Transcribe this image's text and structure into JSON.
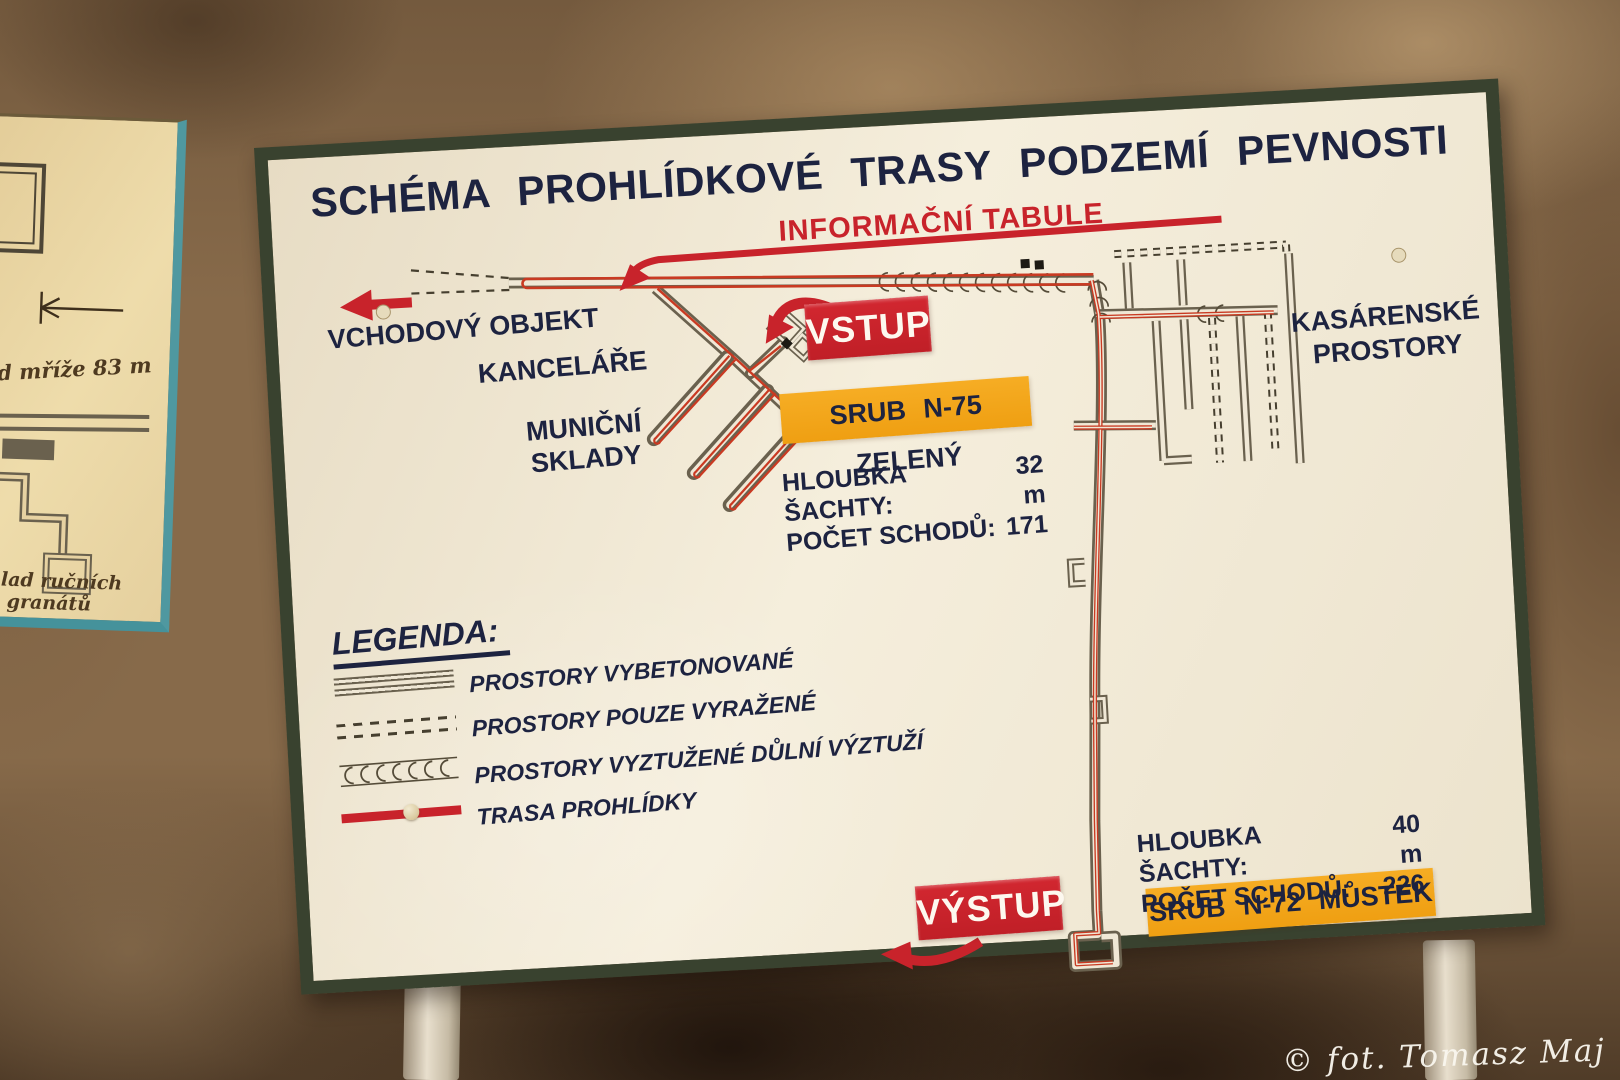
{
  "watermark": "© fot. Tomasz Maj",
  "main_sign": {
    "title": "SCHÉMA PROHLÍDKOVÉ TRASY PODZEMÍ PEVNOSTI",
    "info_board": "INFORMAČNÍ TABULE",
    "entrance_object": "VCHODOVÝ OBJEKT",
    "offices": "KANCELÁŘE",
    "ammo_depot_line1": "MUNIČNÍ",
    "ammo_depot_line2": "SKLADY",
    "barracks_line1": "KASÁRENSKÉ",
    "barracks_line2": "PROSTORY",
    "entry_badge": "VSTUP",
    "exit_badge": "VÝSTUP",
    "bunker_n75_badge": "SRUB N-75 ZELENÝ",
    "bunker_n72_badge": "SRUB N-72 MŮSTEK",
    "shaft_n75": {
      "depth_label": "HLOUBKA ŠACHTY:",
      "depth_value": "32 m",
      "steps_label": "POČET SCHODŮ:",
      "steps_value": "171"
    },
    "shaft_n72": {
      "depth_label": "HLOUBKA ŠACHTY:",
      "depth_value": "40 m",
      "steps_label": "POČET SCHODŮ:",
      "steps_value": "226"
    },
    "legend": {
      "heading": "LEGENDA:",
      "items": [
        {
          "key": "concrete-corridor",
          "label": "PROSTORY VYBETONOVANÉ"
        },
        {
          "key": "excavated-corridor",
          "label": "PROSTORY POUZE VYRAŽENÉ"
        },
        {
          "key": "mine-supported-corridor",
          "label": "PROSTORY VYZTUŽENÉ DŮLNÍ VÝZTUŽÍ"
        },
        {
          "key": "tour-route",
          "label": "TRASA PROHLÍDKY"
        }
      ]
    },
    "colors": {
      "badge_red": "#c8232b",
      "badge_orange": "#f3a81f",
      "text_navy": "#1d2340",
      "route_red": "#c93a22",
      "frame_green": "#39422f",
      "corridor_gray": "#6a614e"
    }
  },
  "left_sign": {
    "distance_note": "od mříže 83 m",
    "caption_line1": "sklad ručních",
    "caption_line2": "granátů"
  }
}
